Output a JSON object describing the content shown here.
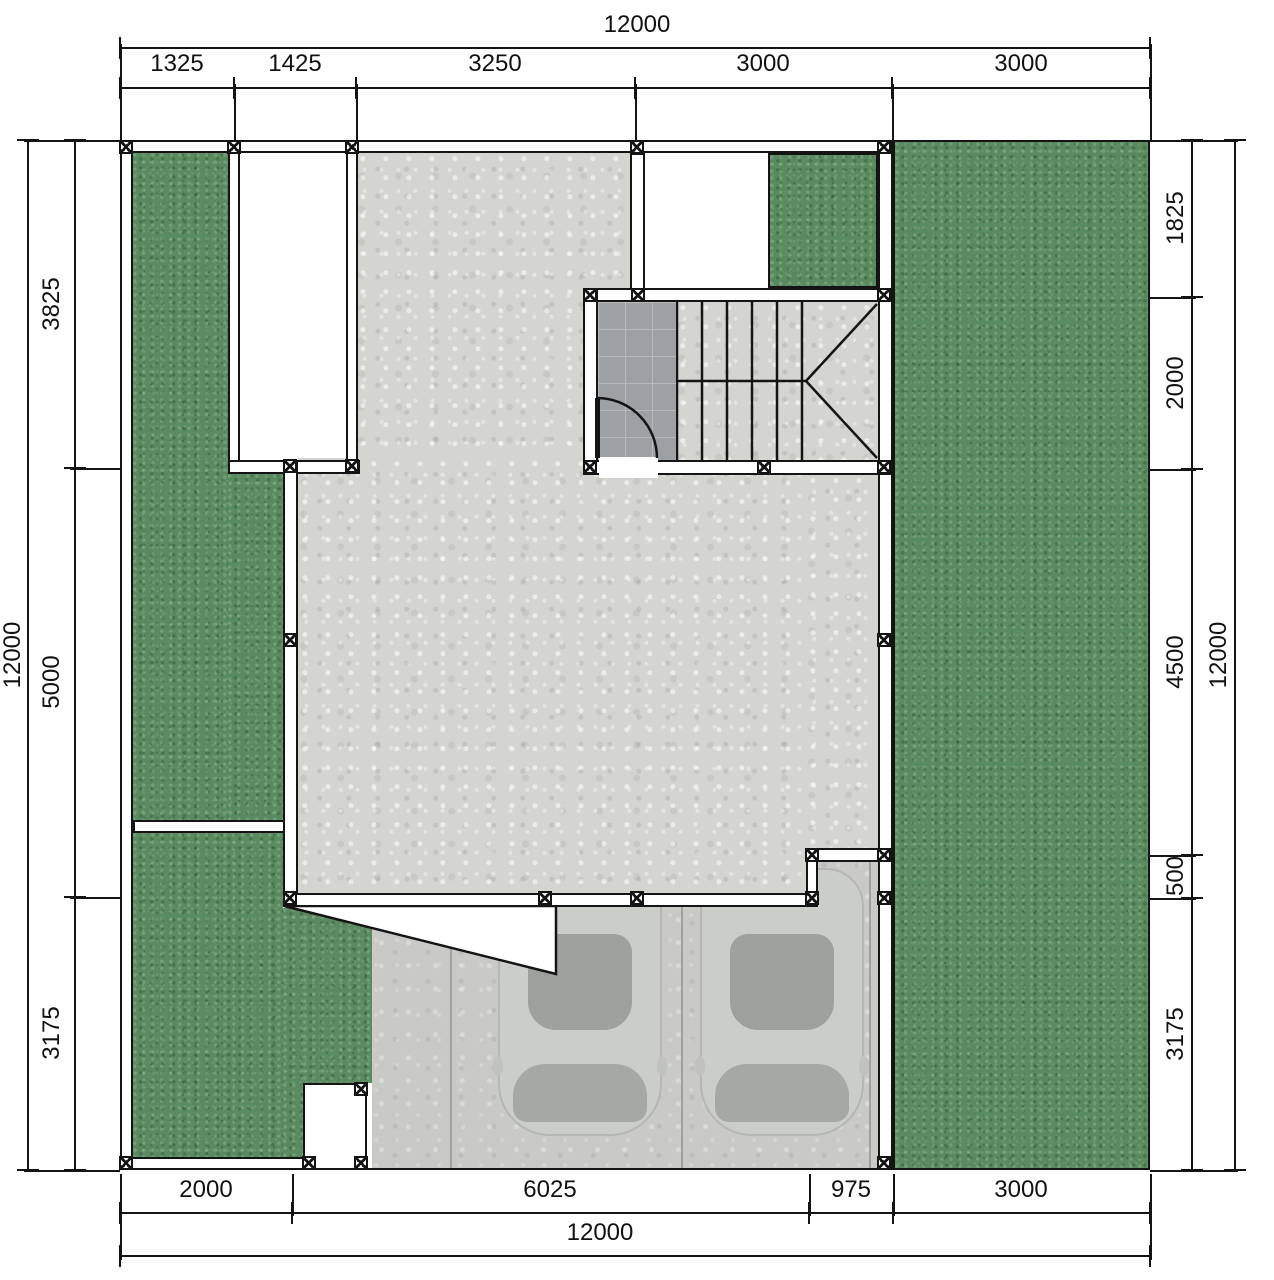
{
  "drawing": {
    "type": "residential-site-floor-plan",
    "plot": {
      "width_label": "12000",
      "height_label": "12000"
    }
  },
  "dims": {
    "top": {
      "overall": "12000",
      "segments": [
        "1325",
        "1425",
        "3250",
        "3000",
        "3000"
      ]
    },
    "left": {
      "overall": "12000",
      "segments": [
        "3825",
        "5000",
        "3175"
      ]
    },
    "right": {
      "overall": "12000",
      "segments": [
        "1825",
        "2000",
        "4500",
        "500",
        "3175"
      ]
    },
    "bottom": {
      "overall": "12000",
      "segments": [
        "2000",
        "6025",
        "975",
        "3000"
      ]
    }
  },
  "colors": {
    "grass": "#5a8a5f",
    "concrete": "#d4d5d1",
    "driveway": "#c9cac6",
    "tile": "#9ea1a4",
    "tile_grid": "#b7babd",
    "wall_fill": "#ffffff",
    "line": "#141414",
    "car_body": "#cbcdc9",
    "car_glass": "#9da09d"
  },
  "icons": {
    "column_marker": "hatched-square-column",
    "door_swing": "quarter-circle-arc",
    "stair_run": "treads-with-winder-diagonals"
  }
}
